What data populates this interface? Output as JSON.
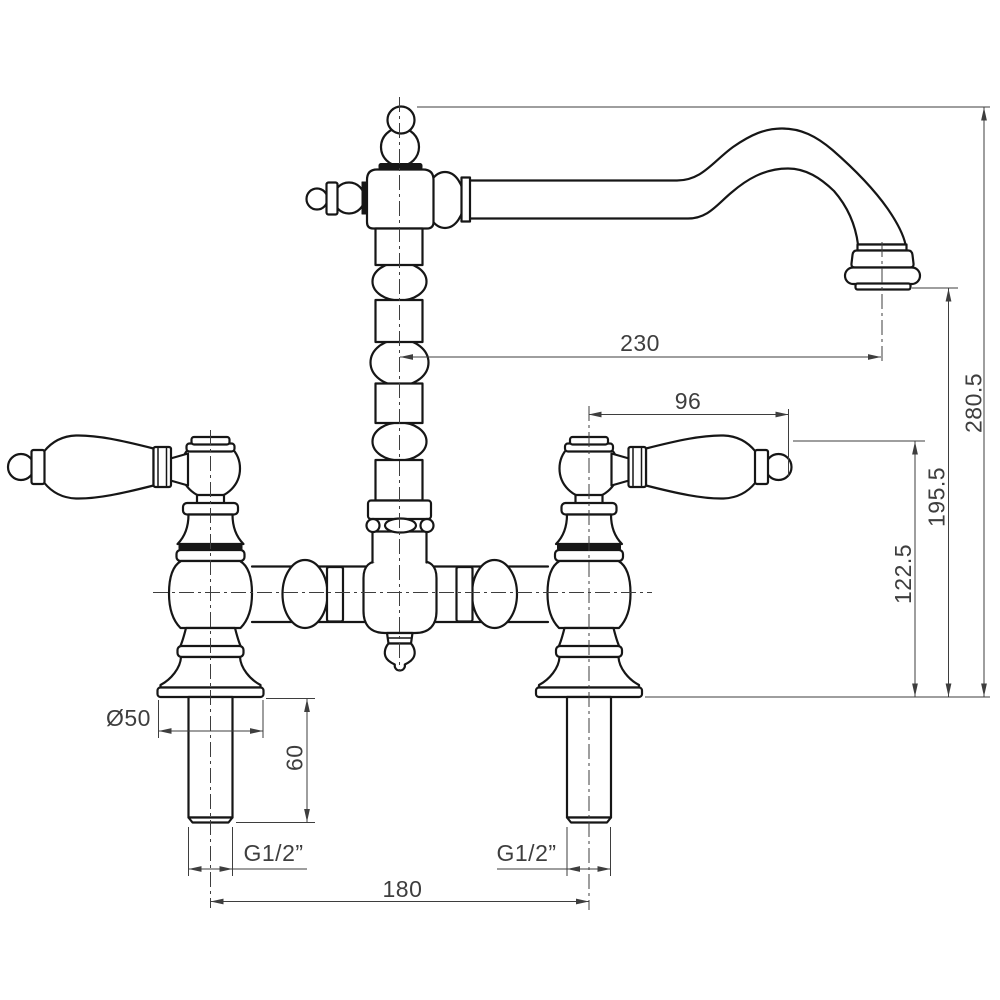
{
  "drawing": {
    "type": "technical dimension drawing",
    "subject": "two-handle bridge mixer tap, front elevation",
    "units_implied": "mm"
  },
  "colors": {
    "outline": "#161616",
    "dim": "#3e3e3e",
    "paper": "#ffffff"
  },
  "dimensions": {
    "spout_reach": "230",
    "handle_length": "96",
    "total_height": "280.5",
    "spout_outlet_height": "195.5",
    "handle_height": "122.5",
    "base_diameter": "Ø50",
    "shank_length": "60",
    "thread_size_left": "G1/2”",
    "thread_size_right": "G1/2”",
    "hole_centres": "180"
  }
}
